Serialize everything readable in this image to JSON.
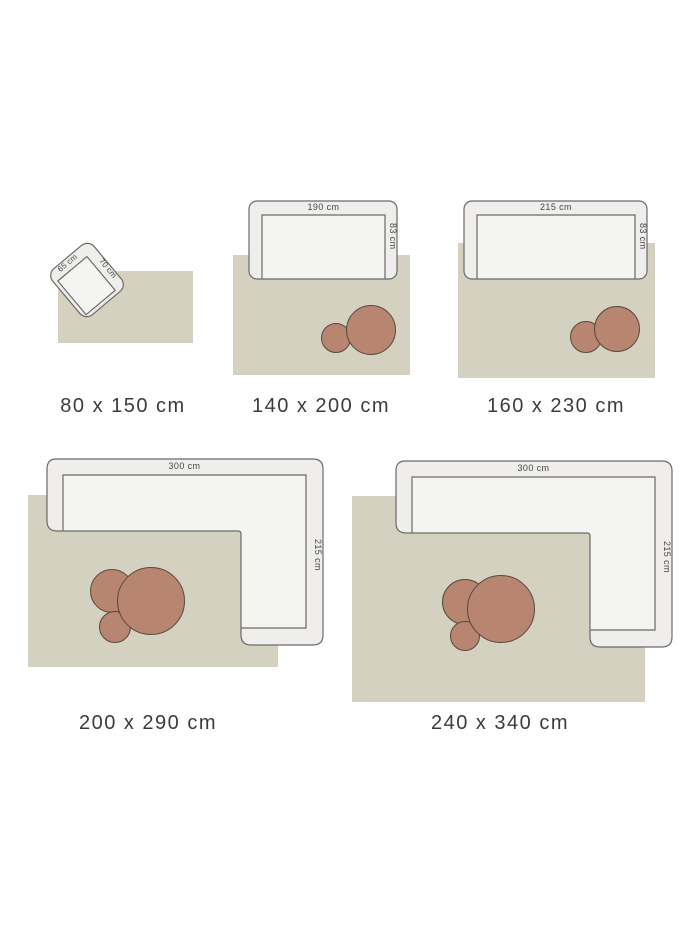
{
  "colors": {
    "background": "#ffffff",
    "rug": "#d4d1c0",
    "furniture_fill": "#efeeec",
    "furniture_seat_fill": "#f4f4f2",
    "furniture_outline": "#6a6a66",
    "table_fill": "#b78570",
    "table_outline": "#564a3d",
    "label_text": "#3b3b3b",
    "dimension_text": "#474747"
  },
  "groups": [
    {
      "id": "rug-80x150",
      "size_label": "80 x 150 cm",
      "furniture_type": "armchair",
      "furniture_width_label": "65 cm",
      "furniture_depth_label": "70 cm"
    },
    {
      "id": "rug-140x200",
      "size_label": "140 x 200 cm",
      "furniture_type": "sofa",
      "furniture_width_label": "190 cm",
      "furniture_depth_label": "83 cm"
    },
    {
      "id": "rug-160x230",
      "size_label": "160 x 230 cm",
      "furniture_type": "sofa",
      "furniture_width_label": "215 cm",
      "furniture_depth_label": "83 cm"
    },
    {
      "id": "rug-200x290",
      "size_label": "200 x 290 cm",
      "furniture_type": "corner-sofa",
      "furniture_width_label": "300 cm",
      "furniture_depth_label": "215 cm"
    },
    {
      "id": "rug-240x340",
      "size_label": "240 x 340 cm",
      "furniture_type": "corner-sofa",
      "furniture_width_label": "300 cm",
      "furniture_depth_label": "215 cm"
    }
  ]
}
